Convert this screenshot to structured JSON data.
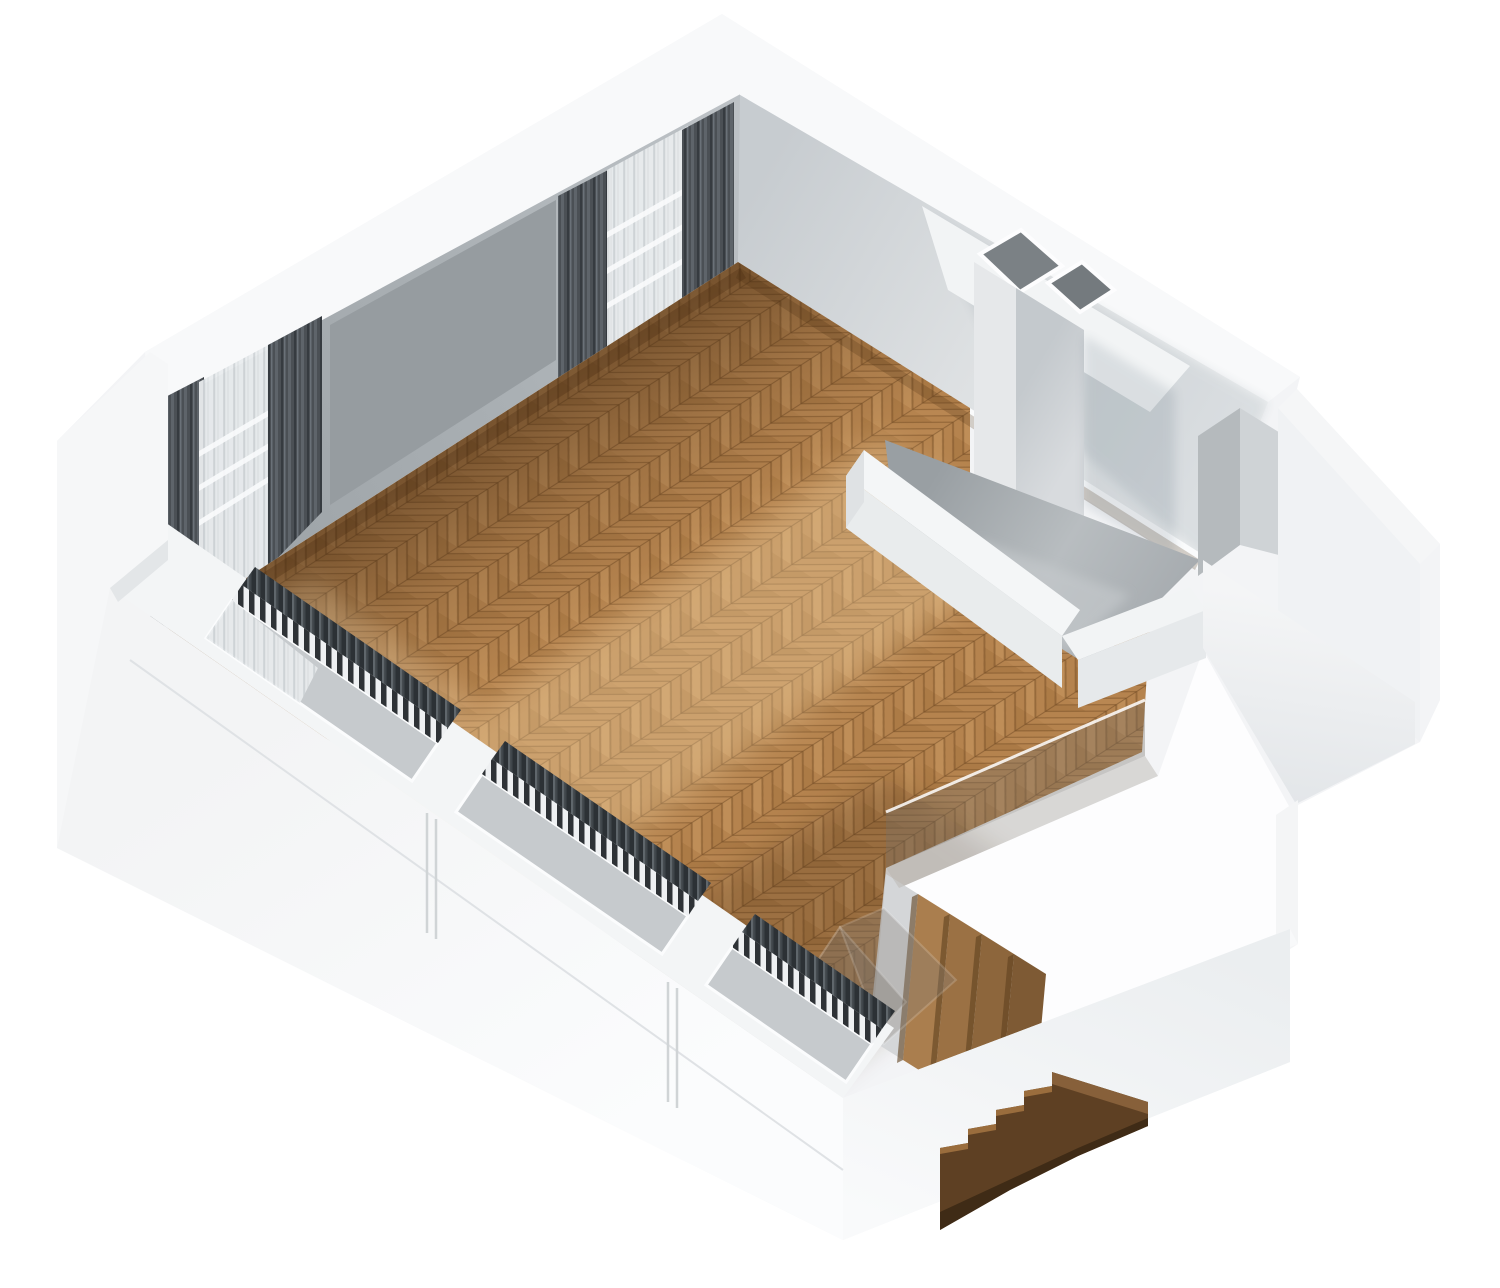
{
  "meta": {
    "view_label": "3d-floorplan-dollhouse-view",
    "scene_label": "living-room-floor-with-stair-void"
  },
  "canvas": {
    "width": 1500,
    "height": 1288,
    "background": "#ffffff"
  },
  "palette": {
    "silhouette": "#f3f4f6",
    "wall_top": "#f8f9fa",
    "wall_outer": "#f0f2f3",
    "wall_outer_deep": "#e7eaec",
    "wall_inner_nw": "#a6abaf",
    "wall_inner_nw_light": "#bfc4c7",
    "wall_panel_shadow": "#969ca0",
    "wall_inner_ne_dark": "#c7ccd0",
    "wall_inner_ne_light": "#eef0f1",
    "baseboard": "#fafbfc",
    "floor_wood": "#b5834e",
    "floor_seam": "#7a5128",
    "floor_shadow": "#38220e",
    "floor_light": "#ffe4b4",
    "nook_floor": "#a0a6aa",
    "nook_floor_light": "#c6cacd",
    "curtain_dark": "#4b5055",
    "curtain_sheer": "#e9ecee",
    "flue_interior": "#7b8185",
    "chimney_front": "#ccd1d4",
    "chimney_side": "#e6e8ea",
    "glass": "#78716a",
    "stair_landing": "#d4d6d8",
    "stair_wood": "#a87c4c",
    "ext_stair_side": "#5e4023",
    "ext_stair_tread": "#9a6d3d",
    "ext_stair_under": "#3f2b16",
    "niche_dark": "#b5babd",
    "niche_light": "#cfd3d6"
  },
  "elements": {
    "nw_wall": "back-left-wall-two-curtained-windows",
    "ne_wall": "back-right-wall-with-chimney",
    "sw_wall": "front-left-cut-wall-three-window-recesses",
    "se_wall": "front-right-cut-wall",
    "floor": "herringbone-parquet-floor",
    "nook": "gray-floor-nook-with-chimney-breast",
    "flues": "two-chimney-flue-openings",
    "glass": "glass-stair-balustrade",
    "stairs_in": "interior-staircase-to-lower-floor",
    "stairs_out": "staircase-fragment-outside-cut-wall",
    "radiators": "white-slat-radiators-in-window-recesses",
    "curtains": "dark-pleated-curtains-and-sheers"
  }
}
